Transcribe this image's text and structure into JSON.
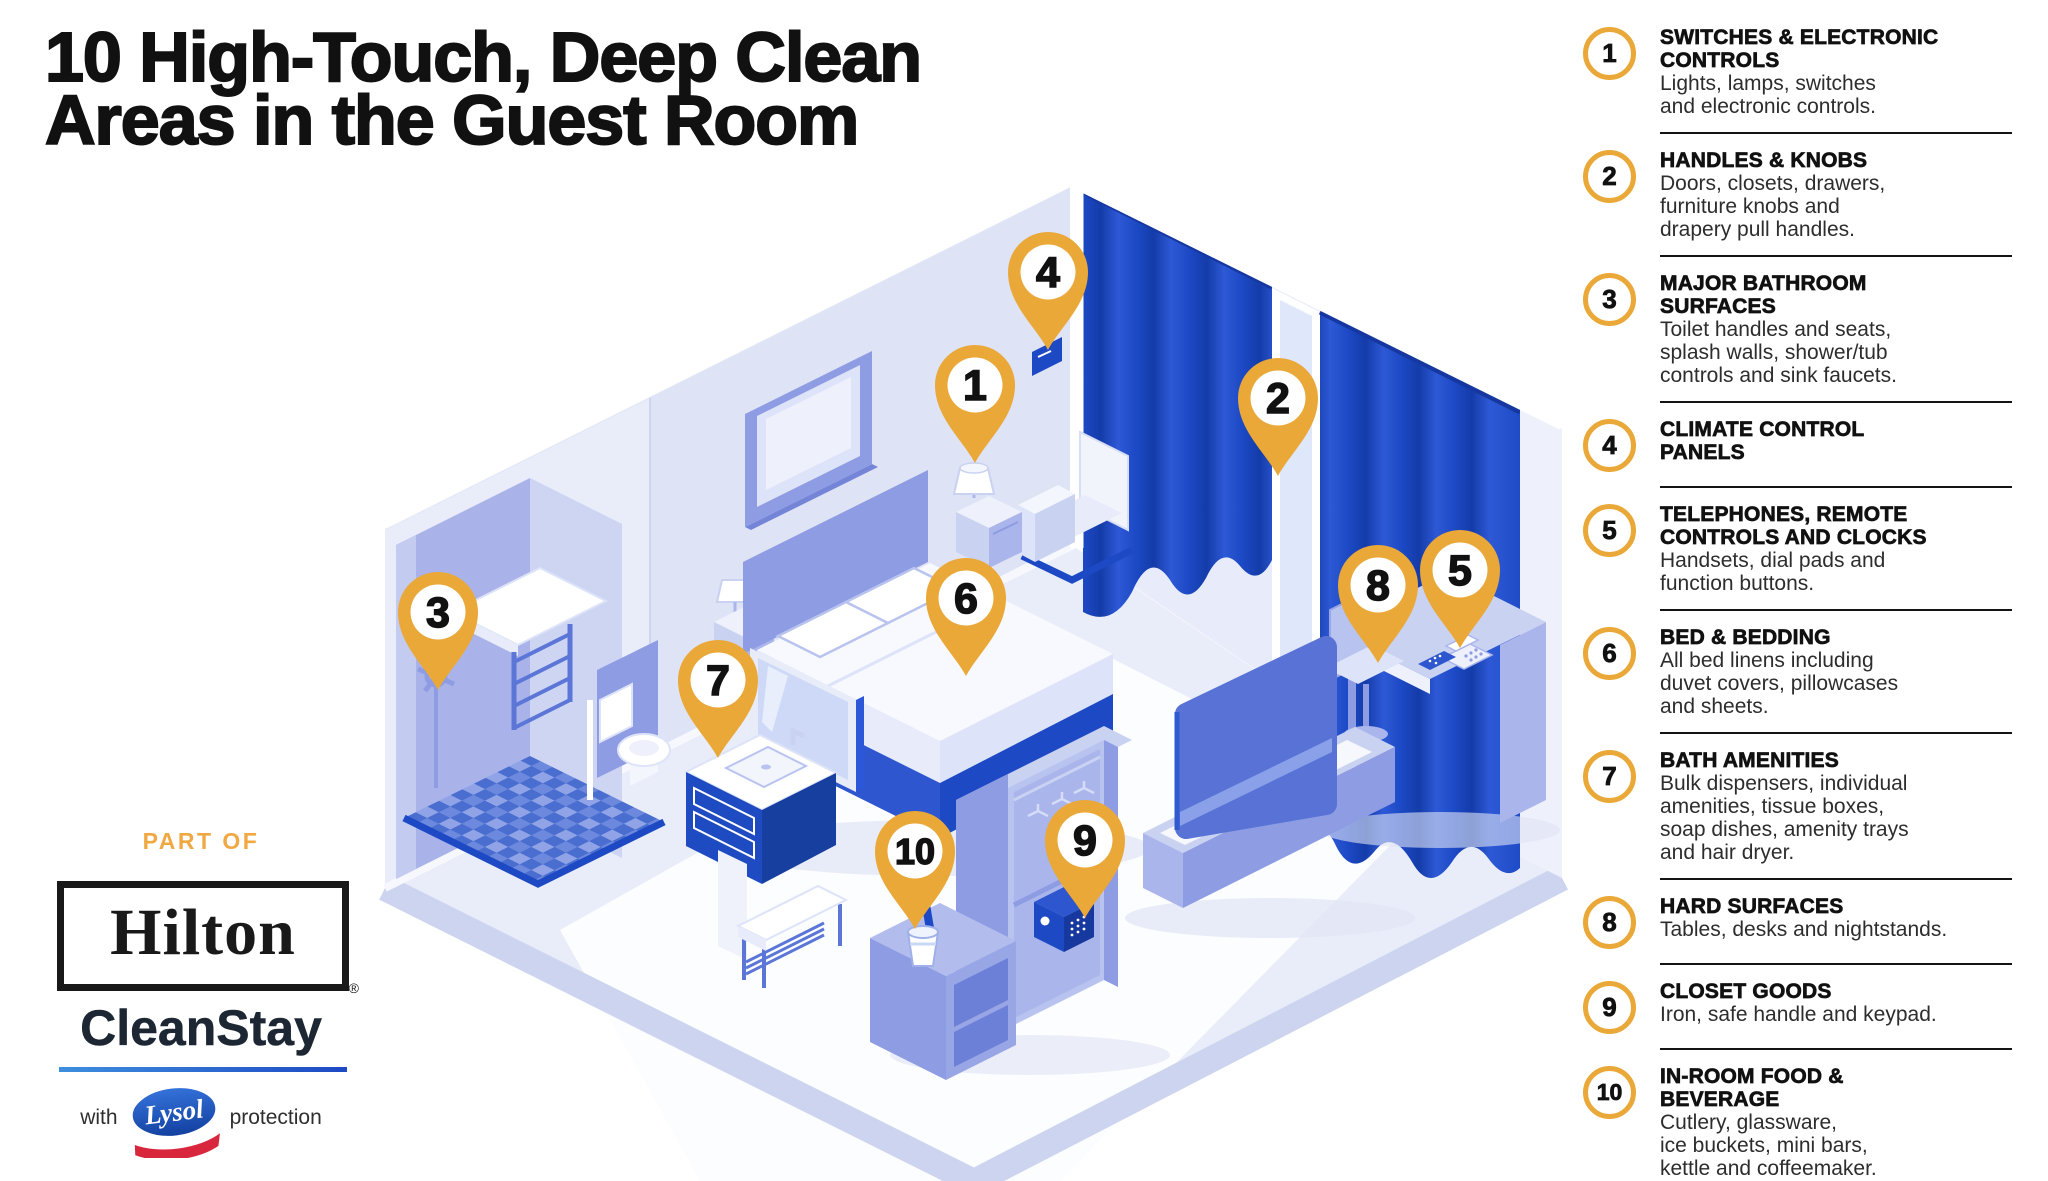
{
  "title": {
    "line1": "10 High-Touch, Deep Clean",
    "line2": "Areas in the Guest Room"
  },
  "legend": {
    "items": [
      {
        "num": "1",
        "title": "SWITCHES & ELECTRONIC\nCONTROLS",
        "desc": "Lights, lamps, switches\nand electronic controls."
      },
      {
        "num": "2",
        "title": "HANDLES & KNOBS",
        "desc": "Doors, closets, drawers,\nfurniture knobs and\ndrapery pull handles."
      },
      {
        "num": "3",
        "title": "MAJOR BATHROOM\nSURFACES",
        "desc": "Toilet handles and seats,\nsplash walls, shower/tub\ncontrols and sink faucets."
      },
      {
        "num": "4",
        "title": "CLIMATE CONTROL\nPANELS",
        "desc": ""
      },
      {
        "num": "5",
        "title": "TELEPHONES, REMOTE\nCONTROLS AND CLOCKS",
        "desc": "Handsets, dial pads and\nfunction buttons."
      },
      {
        "num": "6",
        "title": "BED & BEDDING",
        "desc": "All bed linens including\nduvet covers, pillowcases\nand sheets."
      },
      {
        "num": "7",
        "title": "BATH AMENITIES",
        "desc": "Bulk dispensers, individual\namenities, tissue boxes,\nsoap dishes, amenity trays\nand hair dryer."
      },
      {
        "num": "8",
        "title": "HARD SURFACES",
        "desc": "Tables, desks and nightstands."
      },
      {
        "num": "9",
        "title": "CLOSET GOODS",
        "desc": "Iron, safe handle and keypad."
      },
      {
        "num": "10",
        "title": "IN-ROOM FOOD &\nBEVERAGE",
        "desc": "Cutlery, glassware,\nice buckets, mini bars,\nkettle and coffeemaker."
      }
    ],
    "footnote_dot": "."
  },
  "pins": [
    {
      "num": "1"
    },
    {
      "num": "2"
    },
    {
      "num": "3"
    },
    {
      "num": "4"
    },
    {
      "num": "5"
    },
    {
      "num": "6"
    },
    {
      "num": "7"
    },
    {
      "num": "8"
    },
    {
      "num": "9"
    },
    {
      "num": "10"
    }
  ],
  "branding": {
    "part_of": "PART OF",
    "hilton": "Hilton",
    "registered": "®",
    "cleanstay": "CleanStay",
    "with": "with",
    "lysol": "Lysol",
    "protection": "protection"
  },
  "colors": {
    "accent_gold": "#E9A838",
    "brand_blue": "#1D49C4",
    "curtain_blue": "#1C49C5",
    "ink": "#111111"
  }
}
